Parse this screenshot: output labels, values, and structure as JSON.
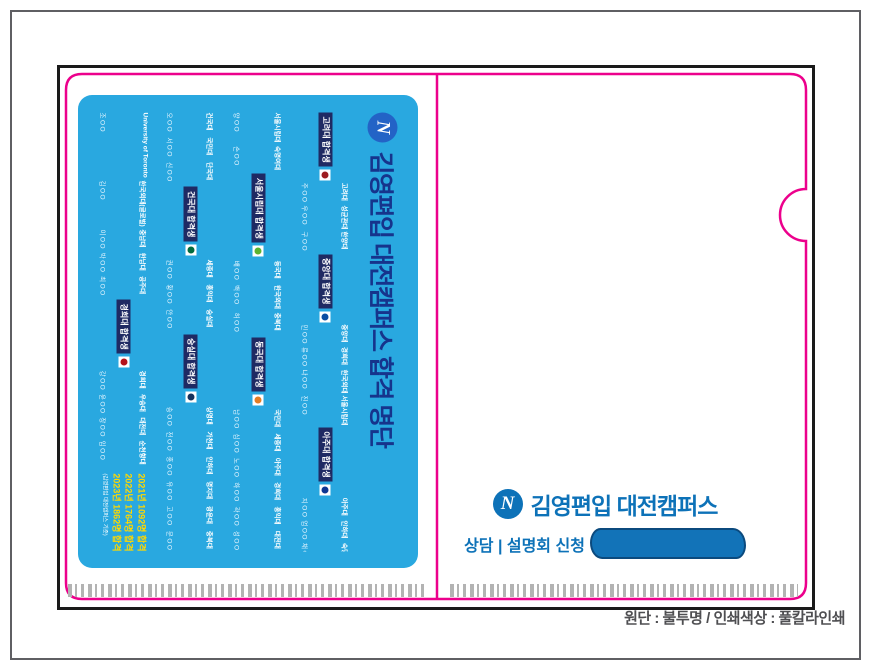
{
  "colors": {
    "card_bg": "#29a8e0",
    "card_title": "#16348c",
    "chip_bg": "#1f2a63",
    "diecut_pink": "#ec008c",
    "outline_black": "#1a1a1a",
    "brand_blue": "#0d72b8",
    "stats_yellow": "#ffd800"
  },
  "front": {
    "logo_letter": "N",
    "brand": "김영편입 대전캠퍼스",
    "cta": "상담 | 설명회 신청"
  },
  "spec_note": "원단 : 불투명 / 인쇄색상 : 풀칼라인쇄",
  "card": {
    "logo_letter": "N",
    "title": "김영편입 대전캠퍼스 합격 명단",
    "stats": {
      "lines": [
        "2021년 1092명 합격",
        "2022년 1764명 합격",
        "2023년 1862명 합격"
      ],
      "caption": "(김영편입 대전캠퍼스 기준)"
    },
    "bands": [
      {
        "items": [
          {
            "type": "entry",
            "school": "University of Toronto",
            "name": "조OO"
          },
          {
            "type": "entry",
            "school": "한국외대(글로벌)",
            "name": "김OO"
          },
          {
            "type": "entry",
            "school": "충남대",
            "name": "이OO"
          },
          {
            "type": "entry",
            "school": "한남대",
            "name": "박OO"
          },
          {
            "type": "entry",
            "school": "공주대",
            "name": "최OO"
          },
          {
            "type": "chip",
            "label": "경희대 합격생",
            "emblem": "#b5121b"
          },
          {
            "type": "entry",
            "school": "경희대",
            "name": "강OO"
          },
          {
            "type": "entry",
            "school": "우송대",
            "name": "윤OO"
          },
          {
            "type": "entry",
            "school": "대전대",
            "name": "장OO"
          },
          {
            "type": "entry",
            "school": "순천향대",
            "name": "임OO"
          },
          {
            "type": "stats"
          }
        ]
      },
      {
        "items": [
          {
            "type": "entry",
            "school": "건국대",
            "name": "오OO"
          },
          {
            "type": "entry",
            "school": "국민대",
            "name": "서OO"
          },
          {
            "type": "entry",
            "school": "단국대",
            "name": "신OO"
          },
          {
            "type": "chip",
            "label": "건국대 합격생",
            "emblem": "#036b3f"
          },
          {
            "type": "entry",
            "school": "세종대",
            "name": "권OO"
          },
          {
            "type": "entry",
            "school": "홍익대",
            "name": "황OO"
          },
          {
            "type": "entry",
            "school": "숭실대",
            "name": "안OO"
          },
          {
            "type": "chip",
            "label": "숭실대 합격생",
            "emblem": "#16325c"
          },
          {
            "type": "entry",
            "school": "상명대",
            "name": "송OO"
          },
          {
            "type": "entry",
            "school": "가천대",
            "name": "전OO"
          },
          {
            "type": "entry",
            "school": "인하대",
            "name": "홍OO"
          },
          {
            "type": "entry",
            "school": "명지대",
            "name": "유OO"
          },
          {
            "type": "entry",
            "school": "광운대",
            "name": "고OO"
          },
          {
            "type": "entry",
            "school": "충북대",
            "name": "문OO"
          }
        ]
      },
      {
        "items": [
          {
            "type": "entry",
            "school": "서울시립대",
            "name": "양OO"
          },
          {
            "type": "entry",
            "school": "숙명여대",
            "name": "손OO"
          },
          {
            "type": "chip",
            "label": "서울시립대 합격생",
            "emblem": "#5bb331"
          },
          {
            "type": "entry",
            "school": "동국대",
            "name": "배OO"
          },
          {
            "type": "entry",
            "school": "한국외대",
            "name": "백OO"
          },
          {
            "type": "entry",
            "school": "충북대",
            "name": "허OO"
          },
          {
            "type": "chip",
            "label": "동국대 합격생",
            "emblem": "#e37d25"
          },
          {
            "type": "entry",
            "school": "국민대",
            "name": "남OO"
          },
          {
            "type": "entry",
            "school": "세종대",
            "name": "심OO"
          },
          {
            "type": "entry",
            "school": "아주대",
            "name": "노OO"
          },
          {
            "type": "entry",
            "school": "경희대",
            "name": "하OO"
          },
          {
            "type": "entry",
            "school": "홍익대",
            "name": "곽OO"
          },
          {
            "type": "entry",
            "school": "대전대",
            "name": "성OO"
          }
        ]
      },
      {
        "items": [
          {
            "type": "chip",
            "label": "고려대 합격생",
            "emblem": "#9d1c20"
          },
          {
            "type": "entry",
            "school": "고려대",
            "name": "주OO"
          },
          {
            "type": "entry",
            "school": "성균관대",
            "name": "우OO"
          },
          {
            "type": "entry",
            "school": "한양대",
            "name": "구OO"
          },
          {
            "type": "chip",
            "label": "중앙대 합격생",
            "emblem": "#0b4da2"
          },
          {
            "type": "entry",
            "school": "중앙대",
            "name": "민OO"
          },
          {
            "type": "entry",
            "school": "경희대",
            "name": "류OO"
          },
          {
            "type": "entry",
            "school": "한국외대",
            "name": "나OO"
          },
          {
            "type": "entry",
            "school": "서울시립대",
            "name": "진OO"
          },
          {
            "type": "chip",
            "label": "아주대 합격생",
            "emblem": "#0d3692"
          },
          {
            "type": "entry",
            "school": "아주대",
            "name": "지OO"
          },
          {
            "type": "entry",
            "school": "인하대",
            "name": "엄OO"
          },
          {
            "type": "entry",
            "school": "숙명여대",
            "name": "채OO"
          }
        ]
      }
    ]
  }
}
